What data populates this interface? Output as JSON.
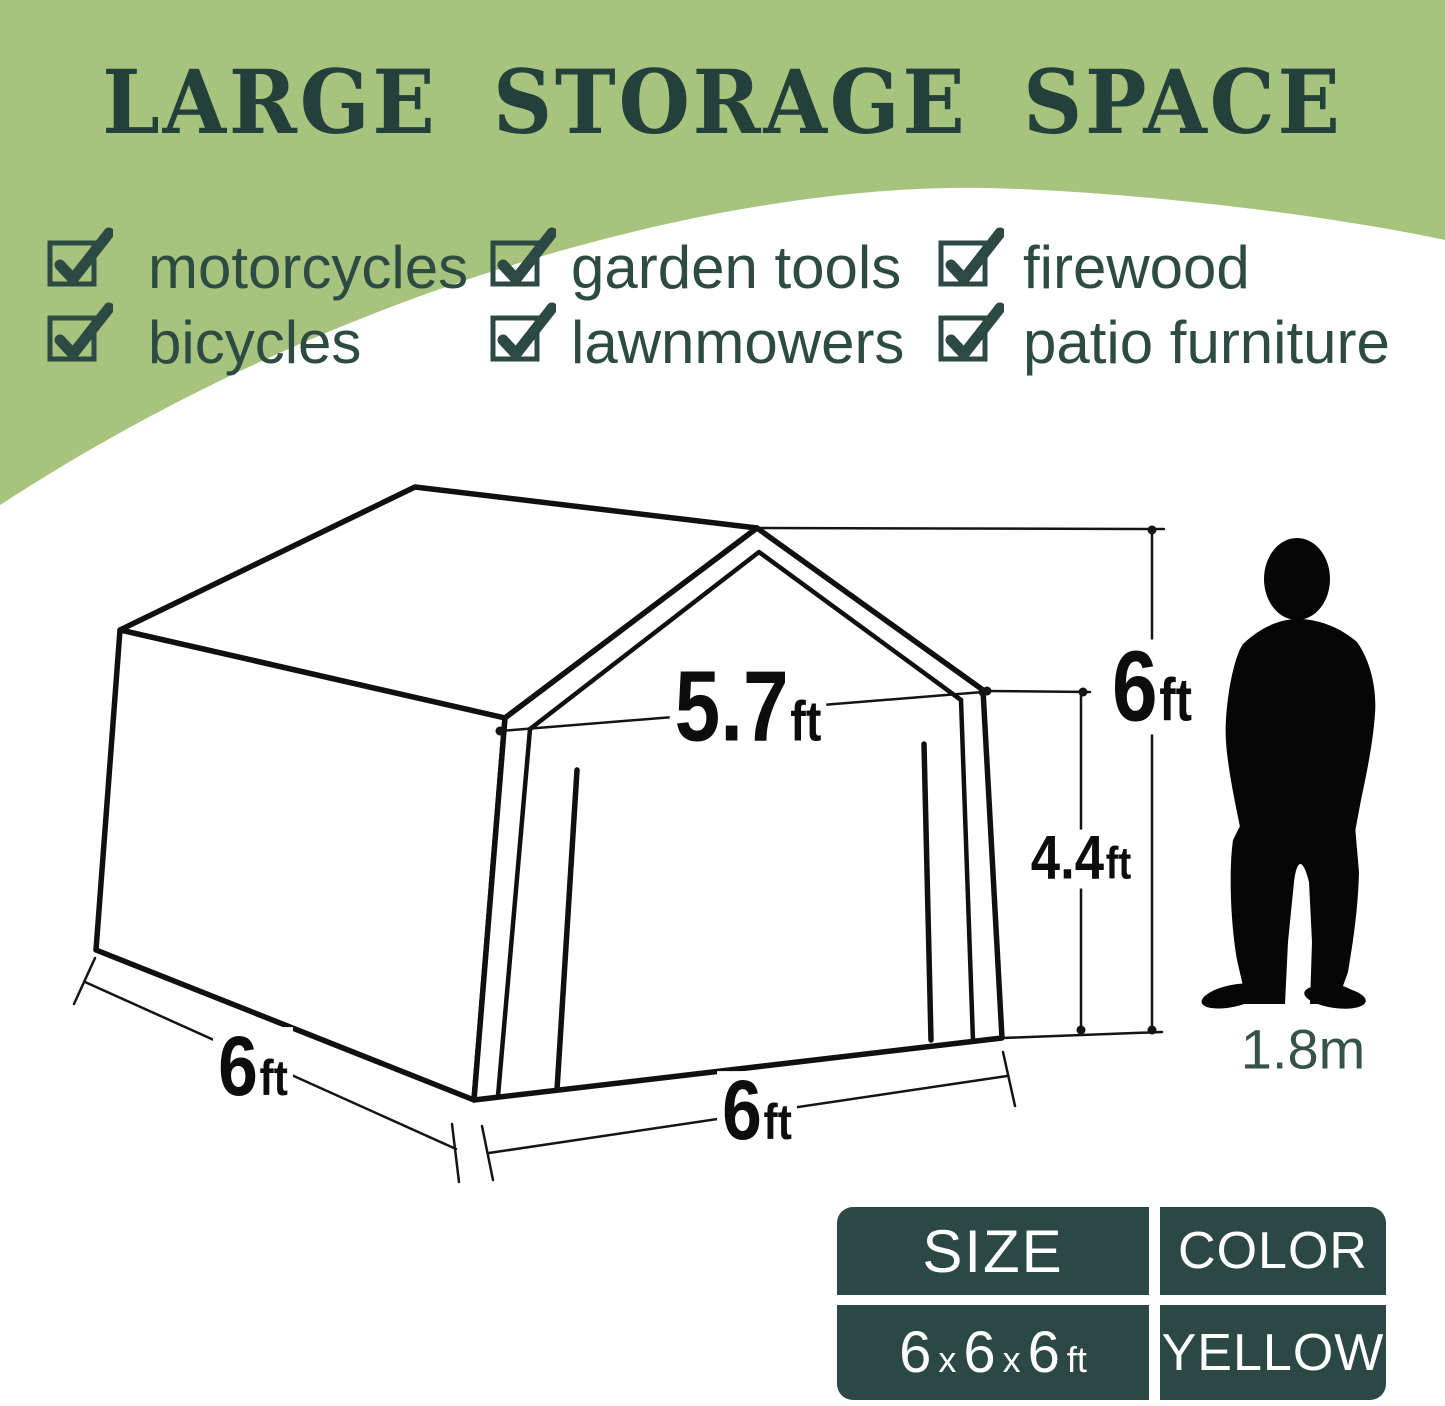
{
  "colors": {
    "background": "#ffffff",
    "header_green": "#a8c37e",
    "title_text": "#24403a",
    "checklist_text": "#2d4a43",
    "line_ink": "#111111",
    "table_cell_bg": "#2b4844",
    "table_text": "#ffffff",
    "person_label_text": "#37514b"
  },
  "header": {
    "title": "LARGE STORAGE SPACE"
  },
  "checklist": {
    "rows": [
      {
        "items": [
          {
            "label": "motorcycles"
          },
          {
            "label": "garden tools"
          },
          {
            "label": "firewood"
          }
        ]
      },
      {
        "items": [
          {
            "label": "bicycles"
          },
          {
            "label": "lawnmowers"
          },
          {
            "label": "patio furniture"
          }
        ]
      }
    ]
  },
  "diagram": {
    "door_width": {
      "value": "5.7",
      "unit": "ft"
    },
    "total_height": {
      "value": "6",
      "unit": "ft"
    },
    "door_height": {
      "value": "4.4",
      "unit": "ft"
    },
    "side_depth": {
      "value": "6",
      "unit": "ft"
    },
    "front_width": {
      "value": "6",
      "unit": "ft"
    },
    "person_height": "1.8m"
  },
  "spec_table": {
    "size_header": "SIZE",
    "color_header": "COLOR",
    "size_value": {
      "d1": "6",
      "sep1": "x",
      "d2": "6",
      "sep2": "x",
      "d3": "6",
      "unit": "ft"
    },
    "color_value": "YELLOW"
  }
}
